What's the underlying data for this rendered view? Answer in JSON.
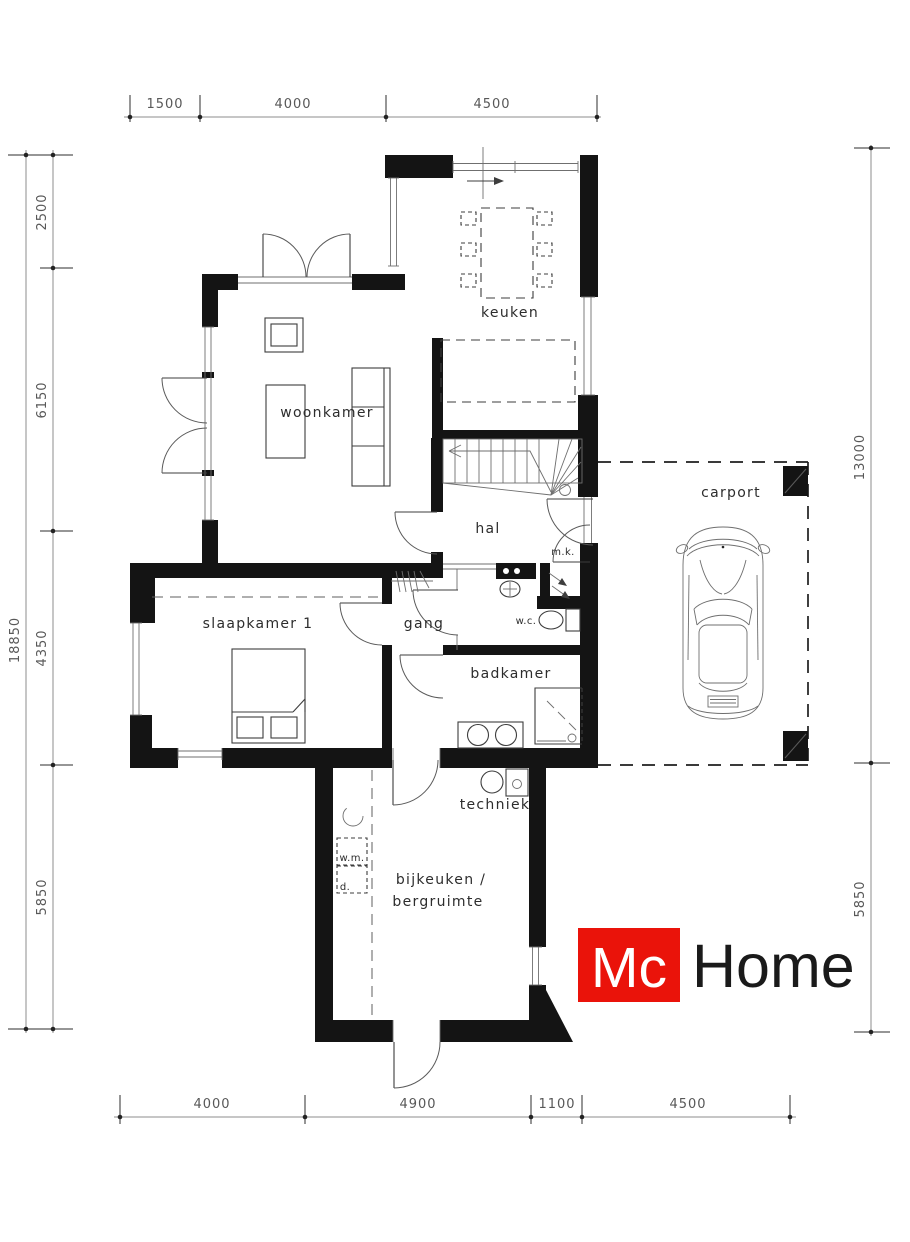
{
  "dims": {
    "top": [
      "1500",
      "4000",
      "4500"
    ],
    "left_total": "18850",
    "left": [
      "2500",
      "6150",
      "4350",
      "5850"
    ],
    "right": [
      "13000",
      "5850"
    ],
    "bottom": [
      "4000",
      "4900",
      "1100",
      "4500"
    ]
  },
  "rooms": {
    "keuken": "keuken",
    "woonkamer": "woonkamer",
    "hal": "hal",
    "mk": "m.k.",
    "gang": "gang",
    "slaapkamer": "slaapkamer 1",
    "wc": "w.c.",
    "badkamer": "badkamer",
    "carport": "carport",
    "techniek": "techniek",
    "bijkeuken_line1": "bijkeuken /",
    "bijkeuken_line2": "bergruimte",
    "wm": "w.m.",
    "d": "d."
  },
  "logo": {
    "mc": "Mc",
    "home": "Home",
    "red": "#ea130a"
  }
}
